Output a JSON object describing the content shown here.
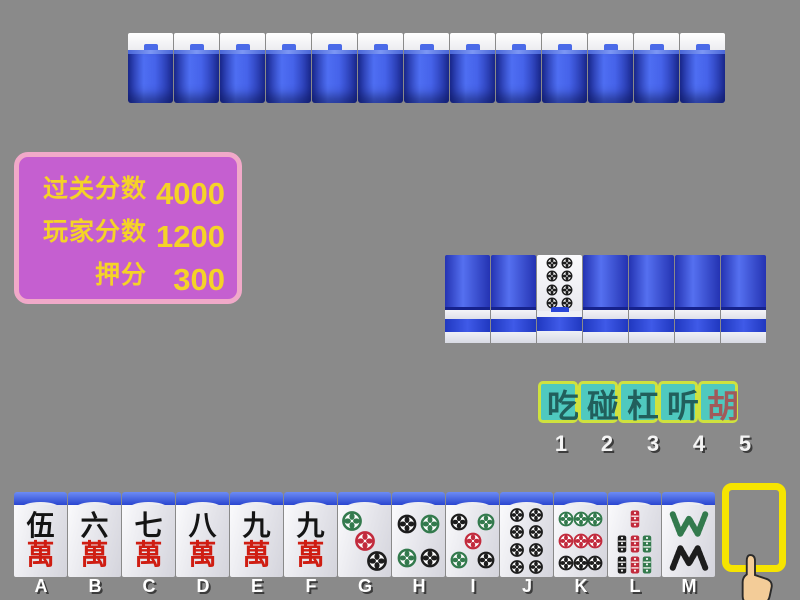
{
  "table": {
    "background": "#8a8a8a"
  },
  "opponent_hand": {
    "tile_count": 13
  },
  "score_panel": {
    "background": "#c55fd0",
    "border_color": "#f1a9c9",
    "text_color": "#f5d327",
    "rows": [
      {
        "label": "过关分数",
        "value": "4000"
      },
      {
        "label": "玩家分数",
        "value": "1200"
      },
      {
        "label": "押分",
        "value": "300"
      }
    ]
  },
  "meld_row": {
    "tiles": [
      {
        "type": "back"
      },
      {
        "type": "back"
      },
      {
        "type": "dots",
        "value": 8,
        "face_up": true
      },
      {
        "type": "back"
      },
      {
        "type": "back"
      },
      {
        "type": "back"
      },
      {
        "type": "back"
      }
    ]
  },
  "action_buttons": {
    "background": "#4fc9bf",
    "border_color": "#cfe23e",
    "items": [
      {
        "label": "吃",
        "number": "1",
        "text_color": "#215f5c"
      },
      {
        "label": "碰",
        "number": "2",
        "text_color": "#215f5c"
      },
      {
        "label": "杠",
        "number": "3",
        "text_color": "#215f5c"
      },
      {
        "label": "听",
        "number": "4",
        "text_color": "#215f5c"
      },
      {
        "label": "胡",
        "number": "5",
        "text_color": "#a15a5a"
      }
    ]
  },
  "player_hand": {
    "tiles": [
      {
        "letter": "A",
        "type": "character",
        "numeral": "伍",
        "suit_char": "萬"
      },
      {
        "letter": "B",
        "type": "character",
        "numeral": "六",
        "suit_char": "萬"
      },
      {
        "letter": "C",
        "type": "character",
        "numeral": "七",
        "suit_char": "萬"
      },
      {
        "letter": "D",
        "type": "character",
        "numeral": "八",
        "suit_char": "萬"
      },
      {
        "letter": "E",
        "type": "character",
        "numeral": "九",
        "suit_char": "萬"
      },
      {
        "letter": "F",
        "type": "character",
        "numeral": "九",
        "suit_char": "萬"
      },
      {
        "letter": "G",
        "type": "dots",
        "value": 3
      },
      {
        "letter": "H",
        "type": "dots",
        "value": 4
      },
      {
        "letter": "I",
        "type": "dots",
        "value": 5
      },
      {
        "letter": "J",
        "type": "dots",
        "value": 8
      },
      {
        "letter": "K",
        "type": "dots",
        "value": 9
      },
      {
        "letter": "L",
        "type": "bamboo",
        "value": 7
      },
      {
        "letter": "M",
        "type": "bamboo",
        "value": 8
      }
    ],
    "draw_slot": {
      "letter": "N",
      "border_color": "#f6e400"
    }
  },
  "suit_colors": {
    "green": "#337a4d",
    "red": "#c22b3d",
    "black": "#1d1d1d",
    "wan_red": "#cf1d12"
  },
  "icons": {
    "cursor": "pointing-hand-icon"
  }
}
